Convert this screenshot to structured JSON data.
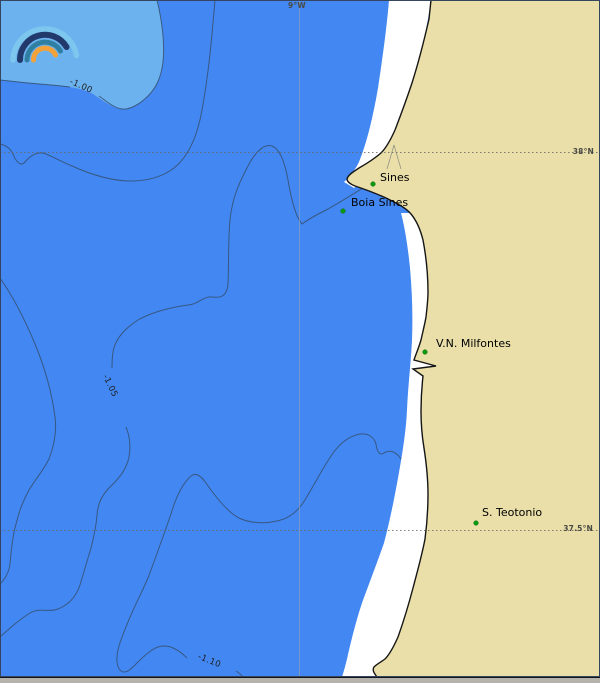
{
  "graticule": {
    "lon_label": "9°W",
    "lat_labels": [
      {
        "label": "38°N"
      },
      {
        "label": "37.5°N"
      }
    ]
  },
  "contours": [
    {
      "label": "-1.00",
      "value": -1.0
    },
    {
      "label": "-1.05",
      "value": -1.05
    },
    {
      "label": "-1.10",
      "value": -1.1
    }
  ],
  "places": [
    {
      "name": "Sines"
    },
    {
      "name": "Boia Sines"
    },
    {
      "name": "V.N. Milfontes"
    },
    {
      "name": "S. Teotonio"
    }
  ],
  "colors": {
    "ocean": "#4387f2",
    "ocean_shallow_pocket": "#6cb2ee",
    "land": "#eadfa9",
    "surf_strip": "#ffffff",
    "coastline": "#161616",
    "contour_line": "#35506f",
    "place_marker_green": "#0a9a10",
    "logo_arcs": [
      "#7dc7ee",
      "#223a6b",
      "#2f7fa3",
      "#f2a238"
    ]
  }
}
